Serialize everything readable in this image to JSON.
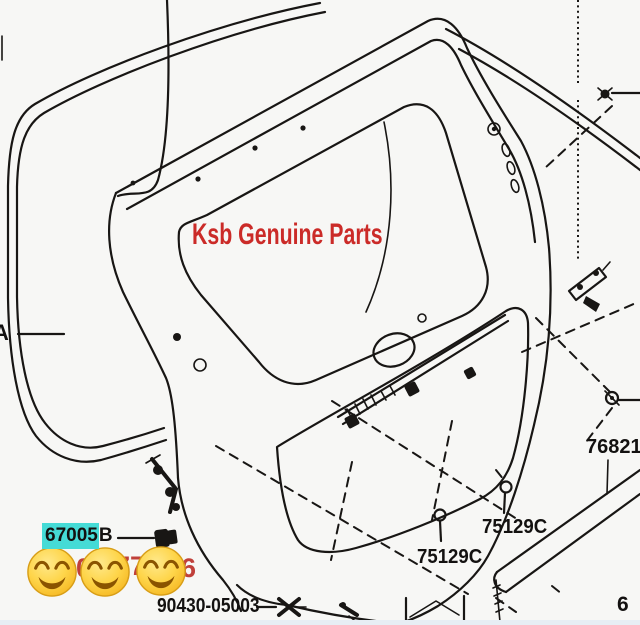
{
  "diagram": {
    "watermark": "Ksb Genuine Parts",
    "callouts": {
      "edge_label": "A",
      "part_highlighted": "67005",
      "part_highlighted_suffix": "B",
      "part_upper_screw": "75129C",
      "part_lower_screw": "75129C",
      "part_molding": "76821",
      "part_grommet": "90430-05003",
      "part_cutoff_right": "6"
    },
    "phone_digits": {
      "d1": "0",
      "d2": "77",
      "d3": "6"
    },
    "emoji_name": "smiling-face-with-smiling-eyes",
    "colors": {
      "watermark_red": "#cb2b28",
      "phone_red": "#c0403a",
      "highlight_cyan": "#45dbd6",
      "line_ink": "#181614",
      "emoji_yellow": "#fecb3e",
      "background": "#f7f7f5"
    }
  }
}
